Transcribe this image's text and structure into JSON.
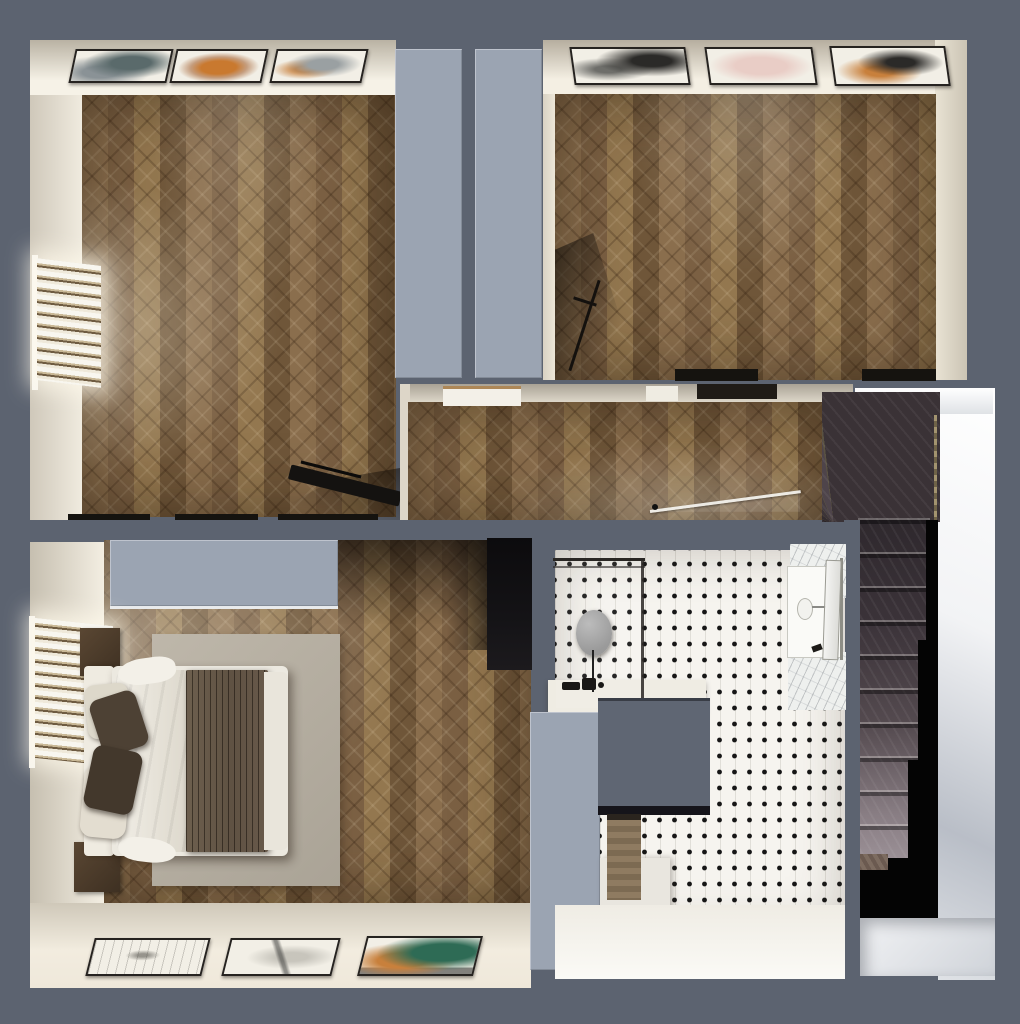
{
  "palette": {
    "canvas_bg": "#5c6370",
    "wall_top_light": "#9ba4b2",
    "wall_beige_dim": "#b9b2a3",
    "wall_beige_lit": "#f6f2e7",
    "wood_base": "#8a6e4d",
    "wood_dark": "#6f5639",
    "tile_white": "#f6f4ef",
    "tile_dot": "#161616",
    "paper": "#f2efe6",
    "art_slate": "#5a6a6b",
    "art_orange": "#c9792f",
    "art_pink": "#e9cdc6",
    "art_black": "#2b2a28",
    "art_green": "#2e6b55",
    "art_amber": "#c8803c",
    "stair_dark": "#2e282d",
    "stair_light": "#9d9298",
    "void_black": "#040404",
    "stairwell_wall_white": "#f2f3f5",
    "bed_white": "#ece9e0",
    "blanket_brown": "#5f5243",
    "pillow_brown": "#4d4134",
    "rug_gray": "#b7b0a4",
    "mirror_gray": "#9a9a9a",
    "wardrobe_black": "#141316",
    "cabinet_wood": "#8f7b61"
  },
  "scene": {
    "view": "top-down 3D rendered floor plan, no text labels",
    "rooms": [
      {
        "name": "room-top-left",
        "floor": "herringbone-parquet",
        "art_frames": 3,
        "objects": [
          "wall-art-frame x3",
          "window-blinds-radiator",
          "black-console-table",
          "door-thresholds"
        ]
      },
      {
        "name": "room-top-right",
        "floor": "herringbone-parquet",
        "art_frames": 3,
        "objects": [
          "wall-art-frame x3",
          "easel-with-shadow",
          "door-thresholds"
        ]
      },
      {
        "name": "hallway",
        "floor": "herringbone-parquet",
        "objects": [
          "open-glass-door",
          "door-thresholds"
        ]
      },
      {
        "name": "staircase",
        "floor": "dark-wood-steps",
        "objects": [
          "winder-steps",
          "straight-flight",
          "stairwell-void",
          "landing",
          "white-stairwell-wall",
          "brass-edge-strip"
        ]
      },
      {
        "name": "bedroom",
        "floor": "herringbone-parquet",
        "art_frames": 3,
        "objects": [
          "double-bed",
          "white-duvet",
          "brown-throw-blanket",
          "pillows x4",
          "headboard",
          "nightstand x2",
          "area-rug",
          "window-blinds-radiator",
          "dark-wardrobe",
          "closet-top",
          "wall-art-frame x3"
        ]
      },
      {
        "name": "bathroom",
        "floor": "white-mosaic-black-dots",
        "objects": [
          "walk-in-shower-glass",
          "round-mirror",
          "black-faucet-set",
          "white-bench",
          "vanity-sink",
          "sink-faucet",
          "marble-counter x2",
          "open-door",
          "wood-cabinet",
          "white-counter",
          "wall-block"
        ]
      }
    ]
  }
}
